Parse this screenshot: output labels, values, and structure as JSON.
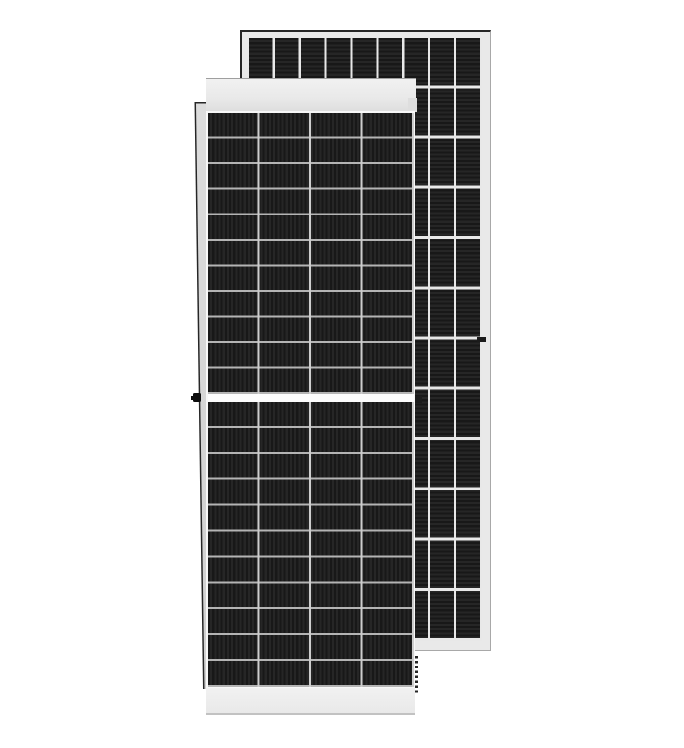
{
  "scene": {
    "type": "product-photo",
    "subject": "Two framed monocrystalline half-cut solar PV modules standing upright on a white background; the front module faces the viewer, a second module stands behind it offset to the upper right",
    "visible_text": "none"
  },
  "front_panel": {
    "label": "front solar module, front face view",
    "cell_columns": 4,
    "cell_rows_per_half": 11,
    "halves": 2,
    "features": [
      "light gray top frame cap",
      "light gray bottom frame cap",
      "white horizontal center divider between cell halves",
      "tapered left side frame edge",
      "black grounding lug protruding on left frame at center height",
      "dark mounting slot on right frame at center height",
      "dashed drainage slots along lower right frame edge",
      "vertical cell striations"
    ]
  },
  "rear_panel": {
    "label": "second solar module behind, cell grid view",
    "cell_columns": 9,
    "cell_rows": 12,
    "features": [
      "light gray frame margin",
      "dark outline along top and left edges",
      "dark mounting slot on right frame",
      "horizontal cell striations",
      "light cell-string dividers"
    ]
  },
  "colors": {
    "bg": "#ffffff",
    "frame": "#e9e9e9",
    "edge_dark": "#262626",
    "edge_mid": "#a8a8a8",
    "stripe_a": "#181818",
    "stripe_b": "#262626",
    "div_row": "#b4b4b4",
    "div_col": "#cdcdcd",
    "div_bright": "#e8e8e8",
    "cell_outline": "#f7f7f7",
    "mid_divider": "#fcfcfc",
    "cap_hi": "#f1f1f1",
    "cap_lo": "#dedede",
    "cap_edge": "#9f9f9f",
    "side_hi": "#dcdcdc",
    "side_lo": "#cfcfcf",
    "bottom_edge": "#c2c2c2",
    "slot_dark": "#1b1b1b",
    "slot_black": "#0d0d0d"
  }
}
